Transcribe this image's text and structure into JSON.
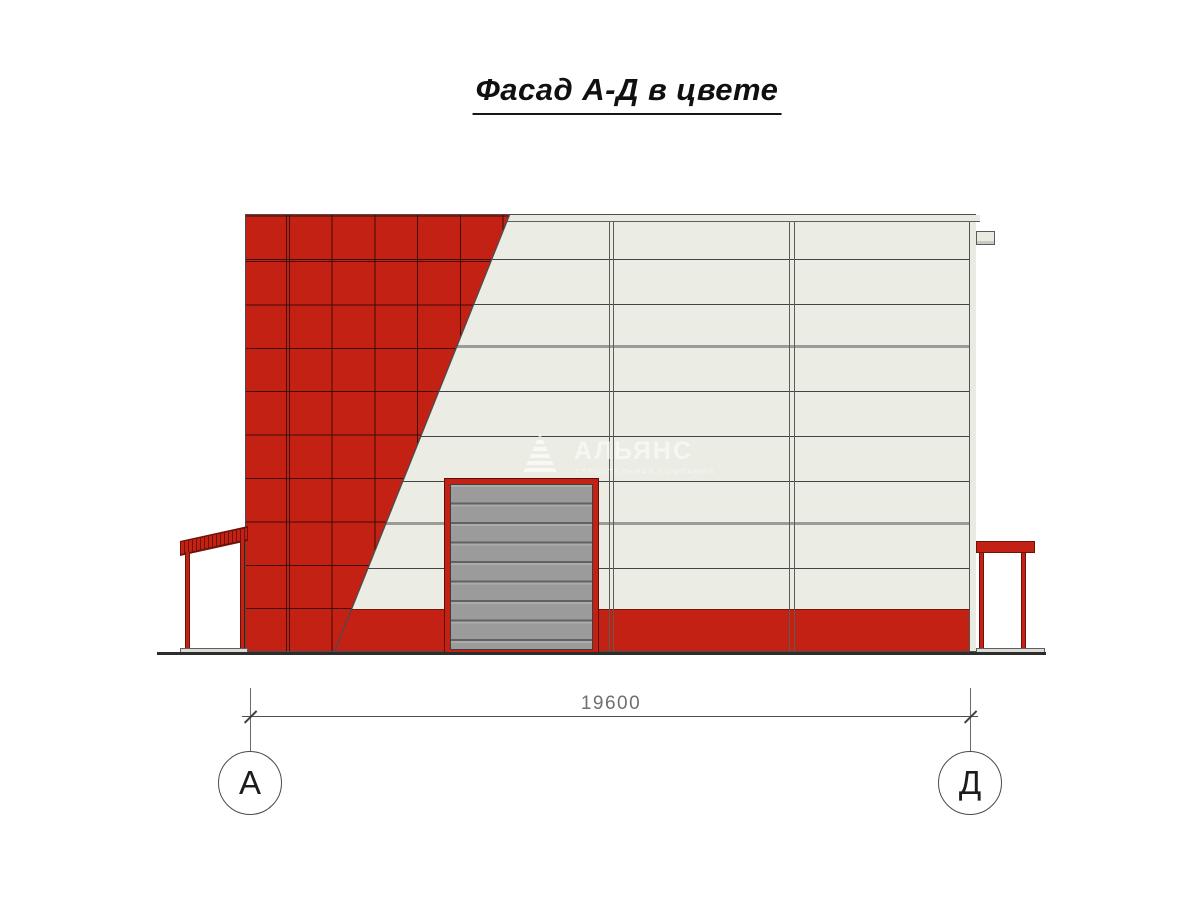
{
  "title": {
    "text": "Фасад А-Д в цвете"
  },
  "watermark": {
    "brand": "АЛЬЯНС",
    "tagline": "СТРОИТЕЛЬНАЯ КОМПАНИЯ"
  },
  "dimension": {
    "value": "19600"
  },
  "axes": [
    {
      "label": "А"
    },
    {
      "label": "Д"
    }
  ],
  "colors": {
    "facade_red": "#c22113",
    "panel_white": "#ebece3",
    "door_gray": "#9b9b9b",
    "plinth_red": "#c22113",
    "outline_gray": "#4c4c4c"
  }
}
